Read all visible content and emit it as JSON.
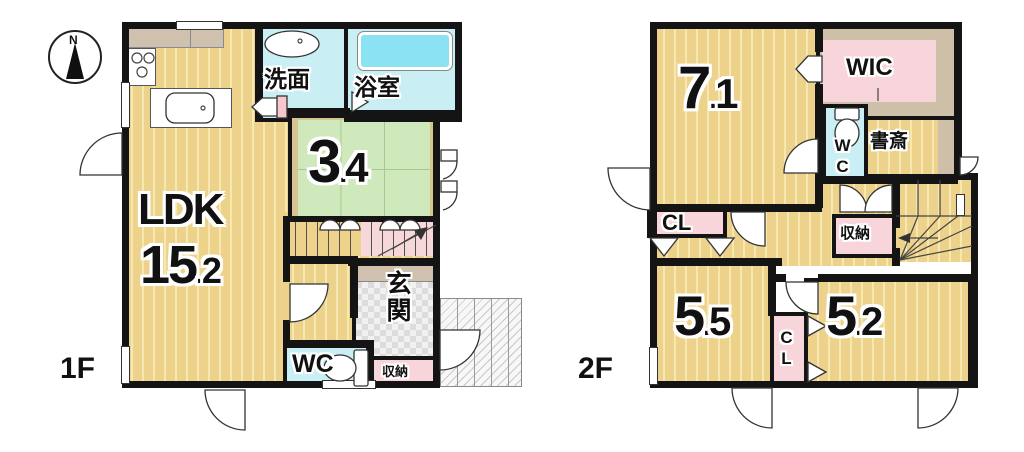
{
  "compass": {
    "label": "N"
  },
  "palette": {
    "wall": "#141414",
    "floor_wood": "#edd28b",
    "tatami_green": "#cfe9bd",
    "wet_cyan": "#c9eff4",
    "bathtub_cyan": "#8be2f2",
    "closet_pink": "#f8d5da",
    "counter_tan": "#cdbfa8",
    "entrance_tile_gray": "#e9e9e9"
  },
  "floors": [
    {
      "label": "1F",
      "rooms": [
        {
          "id": "ldk",
          "label": "LDK",
          "area_num": "15",
          "sep": ".",
          "dec": "2"
        },
        {
          "id": "washroom",
          "label": "洗面"
        },
        {
          "id": "bathroom",
          "label": "浴室"
        },
        {
          "id": "tatami",
          "area_num": "3",
          "sep": ".",
          "dec": "4"
        },
        {
          "id": "entrance",
          "label": "玄関"
        },
        {
          "id": "wc",
          "label": "WC"
        },
        {
          "id": "storage",
          "label": "収納"
        }
      ]
    },
    {
      "label": "2F",
      "rooms": [
        {
          "id": "bedroom-7-1",
          "area_num": "7",
          "sep": ".",
          "dec": "1"
        },
        {
          "id": "wic",
          "label": "WIC"
        },
        {
          "id": "wc",
          "label": "WC"
        },
        {
          "id": "study",
          "label": "書斎"
        },
        {
          "id": "closet-cl",
          "label": "CL"
        },
        {
          "id": "storage",
          "label": "収納"
        },
        {
          "id": "bedroom-5-5",
          "area_num": "5",
          "sep": ".",
          "dec": "5"
        },
        {
          "id": "closet-cl-2",
          "label": "CL"
        },
        {
          "id": "bedroom-5-2",
          "area_num": "5",
          "sep": ".",
          "dec": "2"
        }
      ]
    }
  ]
}
